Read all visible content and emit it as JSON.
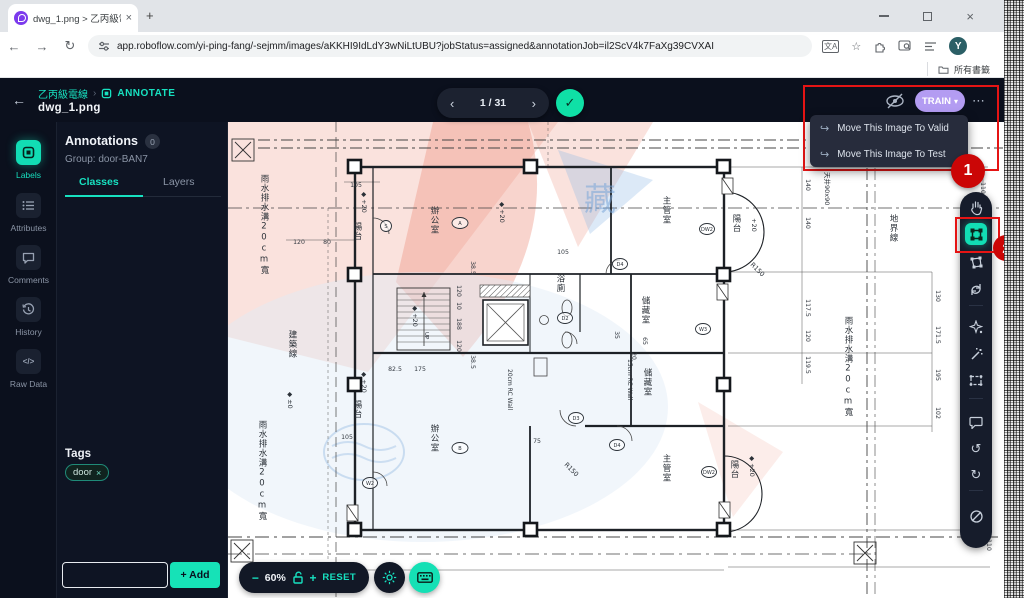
{
  "colors": {
    "accent": "#17e1c0",
    "train": "#b39cf2",
    "callout_red": "#e51414",
    "check_green": "#0fe0a6"
  },
  "browser": {
    "tab_title": "dwg_1.png > 乙丙級電線",
    "tab_close": "×",
    "new_tab": "+",
    "back": "←",
    "forward": "→",
    "reload": "↻",
    "url": "app.roboflow.com/yi-ping-fang/-sejmm/images/aKKHI9IdLdY3wNiLtUBU?jobStatus=assigned&annotationJob=il2ScV4k7FaXg39CVXAI",
    "translate_icon": "文A",
    "star_icon": "☆",
    "avatar_initial": "Y",
    "more_icon": "⋮",
    "bookmarks_label": "所有書籤"
  },
  "header": {
    "back": "←",
    "project": "乙丙級電線",
    "separator": "›",
    "annotate": "ANNOTATE",
    "filename": "dwg_1.png"
  },
  "pager": {
    "prev": "‹",
    "current": "1 / 31",
    "next": "›",
    "check": "✓"
  },
  "topbar": {
    "train": "TRAIN",
    "train_caret": "▾",
    "more": "⋯",
    "menu": [
      {
        "icon": "↪",
        "label": "Move This Image To Valid"
      },
      {
        "icon": "↪",
        "label": "Move This Image To Test"
      }
    ]
  },
  "callouts": {
    "one": "1",
    "two": "2"
  },
  "rail": {
    "items": [
      {
        "label": "Labels"
      },
      {
        "label": "Attributes"
      },
      {
        "label": "Comments"
      },
      {
        "label": "History"
      },
      {
        "label": "Raw Data"
      }
    ]
  },
  "panel": {
    "title": "Annotations",
    "badge": "0",
    "group": "Group: door-BAN7",
    "tabs": {
      "classes": "Classes",
      "layers": "Layers"
    },
    "tags_title": "Tags",
    "tag": "door",
    "tag_close": "×",
    "add": "+ Add"
  },
  "bottombar": {
    "minus": "−",
    "zoom": "60%",
    "plus": "+",
    "reset": "RESET"
  },
  "tools": {
    "undo": "↺",
    "redo": "↻"
  },
  "plan": {
    "labels": [
      {
        "t": "雨水排水溝20cm寬",
        "x": 36,
        "y": 52,
        "v": 1
      },
      {
        "t": "雨水排水溝20cm寬",
        "x": 34,
        "y": 298,
        "v": 1
      },
      {
        "t": "建築線",
        "x": 64,
        "y": 208,
        "v": 1
      },
      {
        "t": "陽台",
        "x": 129,
        "y": 100,
        "v": 1
      },
      {
        "t": "◆ +20",
        "x": 134,
        "y": 70,
        "r": 90
      },
      {
        "t": "陽台",
        "x": 129,
        "y": 278,
        "v": 1
      },
      {
        "t": "◆ +20",
        "x": 134,
        "y": 250,
        "r": 90
      },
      {
        "t": "辦公室",
        "x": 206,
        "y": 84,
        "v": 1
      },
      {
        "t": "主管室",
        "x": 438,
        "y": 74,
        "v": 1
      },
      {
        "t": "儲藏室",
        "x": 417,
        "y": 174,
        "v": 1
      },
      {
        "t": "儲藏室",
        "x": 419,
        "y": 246,
        "v": 1
      },
      {
        "t": "主管室",
        "x": 438,
        "y": 332,
        "v": 1
      },
      {
        "t": "辦公室",
        "x": 206,
        "y": 302,
        "v": 1
      },
      {
        "t": "浴廁",
        "x": 332,
        "y": 152,
        "v": 1
      },
      {
        "t": "陽台",
        "x": 508,
        "y": 92,
        "v": 1
      },
      {
        "t": "+20",
        "x": 524,
        "y": 96,
        "r": 90
      },
      {
        "t": "陽台",
        "x": 506,
        "y": 338,
        "v": 1
      },
      {
        "t": "◆ +20",
        "x": 522,
        "y": 334,
        "r": 90
      },
      {
        "t": "地界線",
        "x": 665,
        "y": 92,
        "v": 1
      },
      {
        "t": "雨水排水溝20cm寬",
        "x": 620,
        "y": 194,
        "v": 1
      },
      {
        "t": "天井90x90",
        "x": 597,
        "y": 50,
        "r": 90
      },
      {
        "t": "15cm RC Wall",
        "x": 400,
        "y": 237,
        "r": 90,
        "s": 6
      },
      {
        "t": "20cm RC Wall",
        "x": 280,
        "y": 247,
        "r": 90,
        "s": 6
      },
      {
        "t": "R150",
        "x": 522,
        "y": 143,
        "r": 45,
        "s": 6.5
      },
      {
        "t": "R150",
        "x": 336,
        "y": 343,
        "r": 45,
        "s": 6.5
      },
      {
        "t": "◆ +20",
        "x": 272,
        "y": 80,
        "r": 90
      },
      {
        "t": "◆ +20",
        "x": 185,
        "y": 184,
        "r": 90
      },
      {
        "t": "◆ ±0",
        "x": 60,
        "y": 270,
        "r": 90
      },
      {
        "t": "UP",
        "x": 197,
        "y": 210,
        "r": 90,
        "s": 5.5
      },
      {
        "t": "藏",
        "x": 356,
        "y": 88,
        "s": 32,
        "wm": 1
      }
    ],
    "dims": [
      {
        "t": "105",
        "x": 128,
        "y": 65
      },
      {
        "t": "120",
        "x": 71,
        "y": 122
      },
      {
        "t": "80",
        "x": 99,
        "y": 122
      },
      {
        "t": "105",
        "x": 335,
        "y": 132
      },
      {
        "t": "82.5",
        "x": 167,
        "y": 249
      },
      {
        "t": "175",
        "x": 192,
        "y": 249
      },
      {
        "t": "75",
        "x": 309,
        "y": 321
      },
      {
        "t": "105",
        "x": 119,
        "y": 317
      },
      {
        "t": "38.5",
        "x": 243,
        "y": 146,
        "r": 90
      },
      {
        "t": "120",
        "x": 229,
        "y": 169,
        "r": 90
      },
      {
        "t": "10",
        "x": 229,
        "y": 184,
        "r": 90
      },
      {
        "t": "188",
        "x": 229,
        "y": 202,
        "r": 90
      },
      {
        "t": "120",
        "x": 229,
        "y": 224,
        "r": 90
      },
      {
        "t": "38.5",
        "x": 243,
        "y": 240,
        "r": 90
      },
      {
        "t": "35",
        "x": 387,
        "y": 213,
        "r": 90
      },
      {
        "t": "65",
        "x": 415,
        "y": 219,
        "r": 90
      },
      {
        "t": "20",
        "x": 404,
        "y": 234,
        "r": 90
      },
      {
        "t": "140",
        "x": 578,
        "y": 63,
        "r": 90
      },
      {
        "t": "140",
        "x": 578,
        "y": 101,
        "r": 90
      },
      {
        "t": "117.5",
        "x": 578,
        "y": 186,
        "r": 90
      },
      {
        "t": "120",
        "x": 578,
        "y": 214,
        "r": 90
      },
      {
        "t": "119.5",
        "x": 578,
        "y": 243,
        "r": 90
      },
      {
        "t": "130",
        "x": 708,
        "y": 174,
        "r": 90
      },
      {
        "t": "171.5",
        "x": 708,
        "y": 213,
        "r": 90
      },
      {
        "t": "195",
        "x": 708,
        "y": 253,
        "r": 90
      },
      {
        "t": "102",
        "x": 708,
        "y": 291,
        "r": 90
      },
      {
        "t": "110",
        "x": 753,
        "y": 66,
        "r": 90
      },
      {
        "t": "110",
        "x": 759,
        "y": 423,
        "r": 90
      }
    ],
    "refs": [
      {
        "t": "A",
        "x": 232,
        "y": 101,
        "o": 1
      },
      {
        "t": "B",
        "x": 232,
        "y": 326,
        "o": 1
      },
      {
        "t": "S",
        "x": 158,
        "y": 104
      },
      {
        "t": "W2",
        "x": 142,
        "y": 361
      },
      {
        "t": "W3",
        "x": 475,
        "y": 207
      },
      {
        "t": "D4",
        "x": 392,
        "y": 142
      },
      {
        "t": "D2",
        "x": 337,
        "y": 196
      },
      {
        "t": "D3",
        "x": 348,
        "y": 296
      },
      {
        "t": "D4",
        "x": 389,
        "y": 323
      },
      {
        "t": "DW2",
        "x": 479,
        "y": 107
      },
      {
        "t": "DW2",
        "x": 481,
        "y": 350
      }
    ]
  }
}
